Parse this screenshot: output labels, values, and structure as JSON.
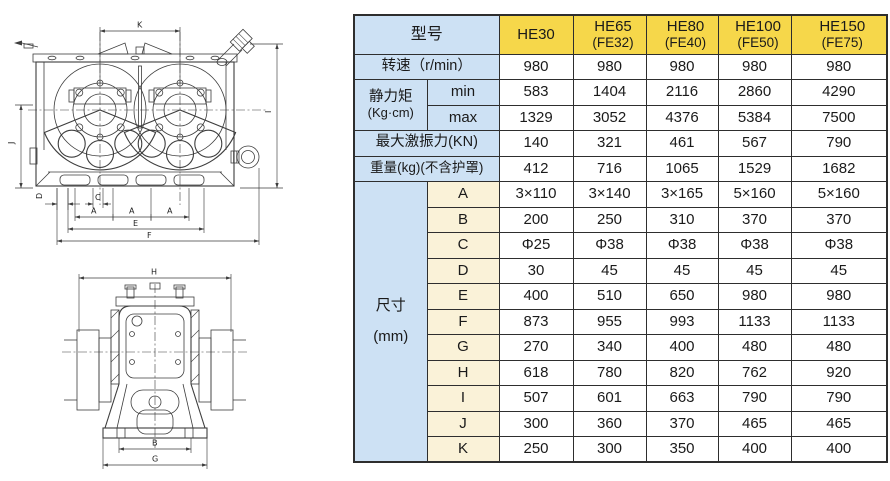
{
  "colors": {
    "page_bg": "#ffffff",
    "header_yellow": "#f6d74a",
    "label_blue": "#cde1f4",
    "letter_cream": "#faf2d8",
    "border": "#2e2e2e",
    "line": "#3d3d3d",
    "text": "#1a1a1a"
  },
  "table": {
    "model_header": "型号",
    "models": [
      {
        "name": "HE30",
        "sub": ""
      },
      {
        "name": "HE65",
        "sub": "(FE32)"
      },
      {
        "name": "HE80",
        "sub": "(FE40)"
      },
      {
        "name": "HE100",
        "sub": "(FE50)"
      },
      {
        "name": "HE150",
        "sub": "(FE75)"
      }
    ],
    "speed": {
      "label": "转速（r/min）",
      "values": [
        "980",
        "980",
        "980",
        "980",
        "980"
      ]
    },
    "static_moment": {
      "label": "静力矩",
      "unit": "(Kg·cm)",
      "min_label": "min",
      "max_label": "max",
      "min": [
        "583",
        "1404",
        "2116",
        "2860",
        "4290"
      ],
      "max": [
        "1329",
        "3052",
        "4376",
        "5384",
        "7500"
      ]
    },
    "max_force": {
      "label": "最大激振力(KN)",
      "values": [
        "140",
        "321",
        "461",
        "567",
        "790"
      ]
    },
    "weight": {
      "label": "重量(kg)(不含护罩)",
      "values": [
        "412",
        "716",
        "1065",
        "1529",
        "1682"
      ]
    },
    "dims": {
      "label": "尺寸",
      "unit": "(mm)",
      "rows": [
        {
          "key": "A",
          "values": [
            "3×110",
            "3×140",
            "3×165",
            "5×160",
            "5×160"
          ]
        },
        {
          "key": "B",
          "values": [
            "200",
            "250",
            "310",
            "370",
            "370"
          ]
        },
        {
          "key": "C",
          "values": [
            "Φ25",
            "Φ38",
            "Φ38",
            "Φ38",
            "Φ38"
          ]
        },
        {
          "key": "D",
          "values": [
            "30",
            "45",
            "45",
            "45",
            "45"
          ]
        },
        {
          "key": "E",
          "values": [
            "400",
            "510",
            "650",
            "980",
            "980"
          ]
        },
        {
          "key": "F",
          "values": [
            "873",
            "955",
            "993",
            "1133",
            "1133"
          ]
        },
        {
          "key": "G",
          "values": [
            "270",
            "340",
            "400",
            "480",
            "480"
          ]
        },
        {
          "key": "H",
          "values": [
            "618",
            "780",
            "820",
            "762",
            "920"
          ]
        },
        {
          "key": "I",
          "values": [
            "507",
            "601",
            "663",
            "790",
            "790"
          ]
        },
        {
          "key": "J",
          "values": [
            "300",
            "360",
            "370",
            "465",
            "465"
          ]
        },
        {
          "key": "K",
          "values": [
            "250",
            "300",
            "350",
            "400",
            "400"
          ]
        }
      ]
    }
  },
  "drawing": {
    "front_view": {
      "dim_labels": {
        "K": "K",
        "J": "J",
        "I": "I",
        "D": "D",
        "C": "C",
        "A1": "A",
        "A2": "A",
        "A3": "A",
        "E": "E",
        "F": "F"
      }
    },
    "side_view": {
      "dim_labels": {
        "H": "H",
        "B": "B",
        "G": "G"
      }
    }
  }
}
